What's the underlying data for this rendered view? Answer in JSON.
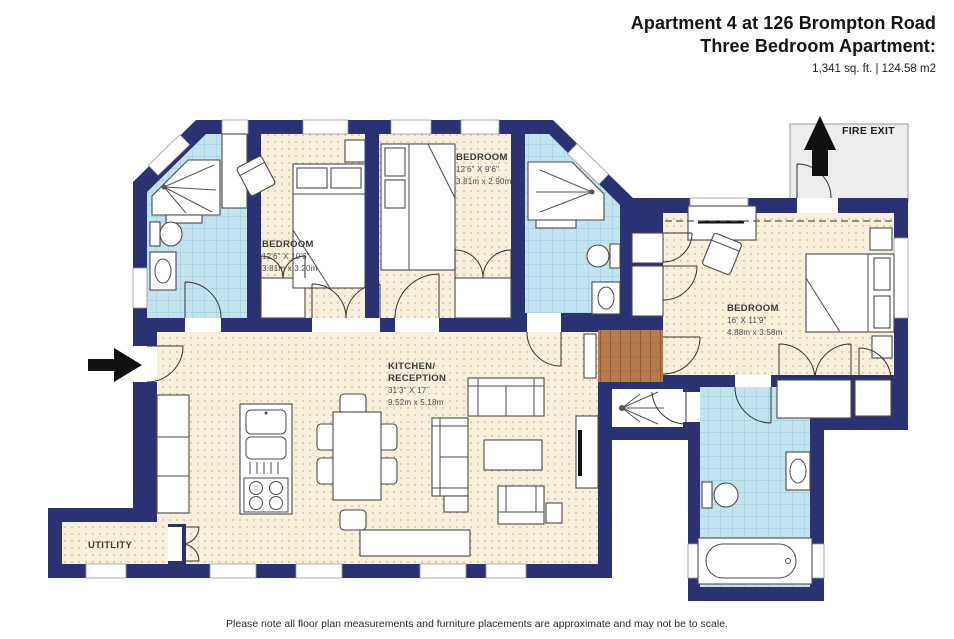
{
  "header": {
    "title": "Apartment 4 at 126 Brompton Road",
    "subtitle": "Three Bedroom Apartment:",
    "area_line": "1,341 sq. ft. | 124.58 m2"
  },
  "plan": {
    "rooms": {
      "bedroom_left": {
        "name": "BEDROOM",
        "dims_ft": "12'6\" X 10'6\"",
        "dims_m": "3.81m x 3.20m"
      },
      "bedroom_top": {
        "name": "BEDROOM",
        "dims_ft": "12'6\" X 9'6\"",
        "dims_m": "3.81m x 2.90m"
      },
      "bedroom_right": {
        "name": "BEDROOM",
        "dims_ft": "16' X 11'9\"",
        "dims_m": "4.88m x 3.58m"
      },
      "kitchen_reception": {
        "name_line1": "KITCHEN/",
        "name_line2": "RECEPTION",
        "dims_ft": "31'3\" X 17'",
        "dims_m": "9.52m x 5.18m"
      },
      "utility": {
        "name": "UTITLITY"
      }
    },
    "annotations": {
      "fire_exit": "FIRE EXIT"
    },
    "icons": {
      "entry_arrow": "right-arrow",
      "fire_exit_arrow": "up-arrow"
    },
    "colors": {
      "wall": "#2b3274",
      "floor_cream": "#f8f0dc",
      "floor_dot": "#c9b88c",
      "tile_blue": "#c3e3ef",
      "tile_line": "#96c8da",
      "wood": "#b5794e",
      "fire_exit_landing": "#ededed",
      "arrow_black": "#111111",
      "furniture_outline": "#4a4a4a"
    }
  },
  "footer": {
    "note": "Please note all floor plan measurements and furniture placements are approximate and may not be to scale."
  }
}
